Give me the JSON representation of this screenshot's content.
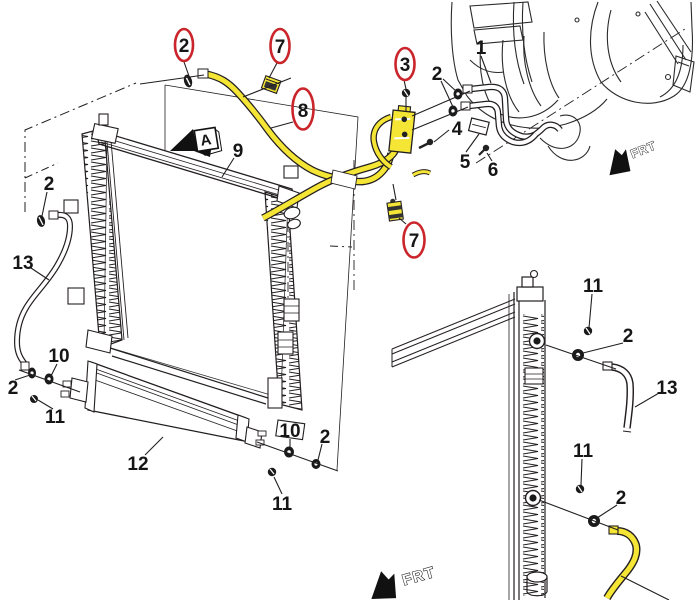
{
  "labels": {
    "1": "1",
    "2": "2",
    "3": "3",
    "4": "4",
    "5": "5",
    "6": "6",
    "7": "7",
    "8": "8",
    "9": "9",
    "10": "10",
    "11": "11",
    "12": "12",
    "13": "13"
  },
  "view_marker": "A",
  "direction_marker": "FRT",
  "colors": {
    "highlight_yellow": "#f5e636",
    "callout_ring_red": "#c9252b",
    "line_ink": "#231f20"
  }
}
